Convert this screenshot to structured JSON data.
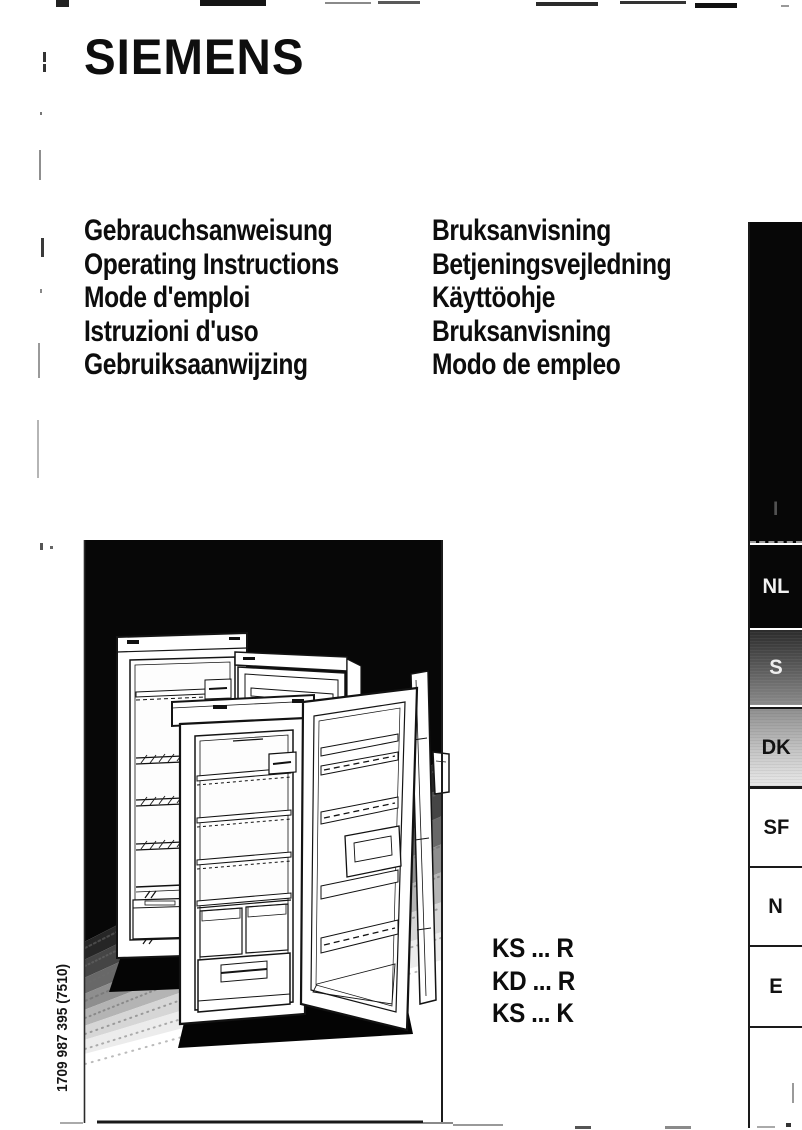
{
  "page": {
    "brand": "SIEMENS",
    "background_color": "#ffffff",
    "ink_color": "#111111"
  },
  "titles": {
    "left": [
      "Gebrauchsanweisung",
      "Operating Instructions",
      "Mode d'emploi",
      "Istruzioni d'uso",
      "Gebruiksaanwijzing"
    ],
    "right": [
      "Bruksanvisning",
      "Betjeningsvejledning",
      "Käyttöohje",
      "Bruksanvisning",
      "Modo de empleo"
    ]
  },
  "models": [
    "KS ... R",
    "KD ... R",
    "KS ... K"
  ],
  "order_number": "1709 987 395 (7510)",
  "tabs": [
    {
      "label": "I",
      "bg": "#070707",
      "fg": "rgba(255,255,255,0.3)"
    },
    {
      "label": "NL",
      "bg": "#070707",
      "fg": "#f2f2f2"
    },
    {
      "label": "S",
      "bg": "repeating-linear-gradient(0deg, rgba(255,255,255,0.05) 0px, rgba(255,255,255,0.05) 1px, rgba(0,0,0,0) 1px, rgba(0,0,0,0) 3px), linear-gradient(180deg, #2b2b2b 0%, #555555 45%, #8a8a8a 100%)",
      "fg": "#efefef"
    },
    {
      "label": "DK",
      "bg": "repeating-linear-gradient(0deg, rgba(0,0,0,0.05) 0px, rgba(0,0,0,0.05) 1px, rgba(0,0,0,0) 1px, rgba(0,0,0,0) 3px), linear-gradient(180deg, #909090 0%, #c6c6c6 55%, #e9e9e9 100%)",
      "fg": "#121212"
    },
    {
      "label": "SF",
      "bg": "#ffffff",
      "fg": "#121212"
    },
    {
      "label": "N",
      "bg": "#ffffff",
      "fg": "#121212"
    },
    {
      "label": "E",
      "bg": "#ffffff",
      "fg": "#121212"
    }
  ]
}
